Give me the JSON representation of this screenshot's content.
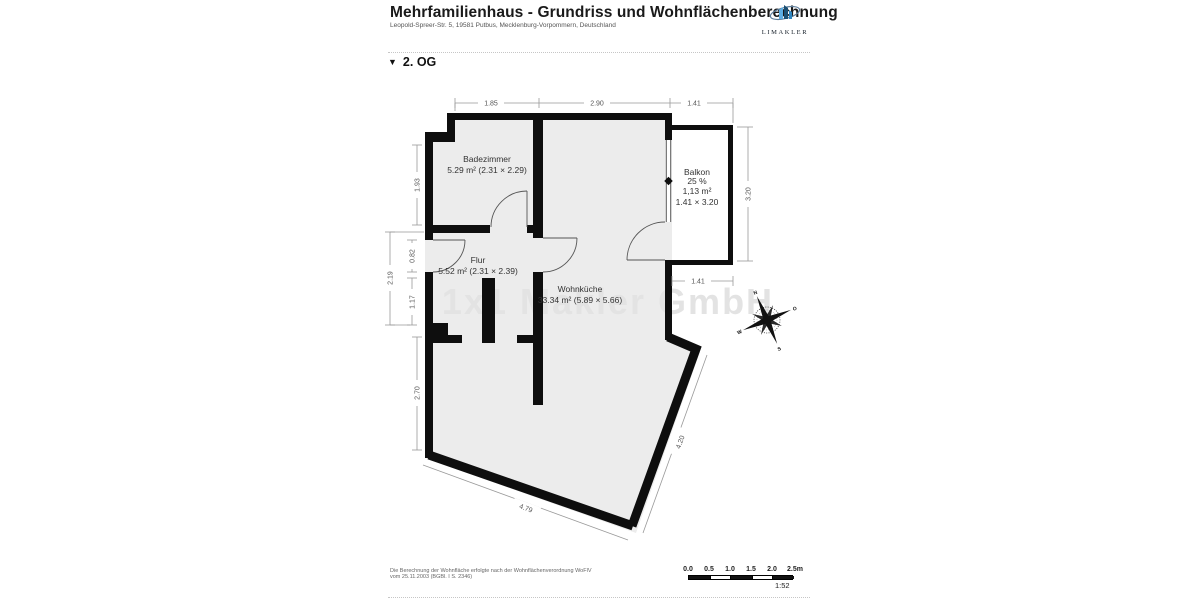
{
  "header": {
    "title": "Mehrfamilienhaus - Grundriss und Wohnflächenberechnung",
    "subtitle": "Leopold-Spreer-Str. 5, 19581 Putbus, Mecklenburg-Vorpommern, Deutschland",
    "logo_text": "LIMAKLER"
  },
  "section": {
    "marker": "▼",
    "label": "2. OG"
  },
  "plan": {
    "rooms": [
      {
        "name": "Badezimmer",
        "details": "5.29 m² (2.31 × 2.29)"
      },
      {
        "name": "Flur",
        "details": "5.52 m² (2.31 × 2.39)"
      },
      {
        "name": "Wohnküche",
        "details": "33.34 m² (5.89 × 5.66)"
      },
      {
        "name": "Balkon",
        "percent": "25 %",
        "area": "1,13 m²",
        "size": "1.41 × 3.20"
      }
    ],
    "dimensions": {
      "top_left": "1.85",
      "top_mid": "2.90",
      "top_right": "1.41",
      "right_balcony": "3.20",
      "below_balcony": "1.41",
      "left_bath": "1.93",
      "left_door": "0.82",
      "left_total": "2.19",
      "left_lower": "1.17",
      "left_bottom": "2.70",
      "diag_left": "4.79",
      "diag_right": "4.20"
    },
    "compass": {
      "n": "N",
      "e": "O",
      "s": "S",
      "w": "W"
    },
    "watermark": "1x1 Makler GmbH"
  },
  "footer": {
    "note_line1": "Die Berechnung der Wohnfläche erfolgte nach der Wohnflächenverordnung WoFlV",
    "note_line2": "vom 25.11.2003 (BGBl. I S. 2346)",
    "scalebar": {
      "ticks": [
        "0.0",
        "0.5",
        "1.0",
        "1.5",
        "2.0",
        "2.5m"
      ],
      "ratio": "1:52"
    }
  },
  "colors": {
    "wall": "#0e0e0e",
    "floor": "#ececec",
    "logo_accent": "#1b4f72"
  }
}
